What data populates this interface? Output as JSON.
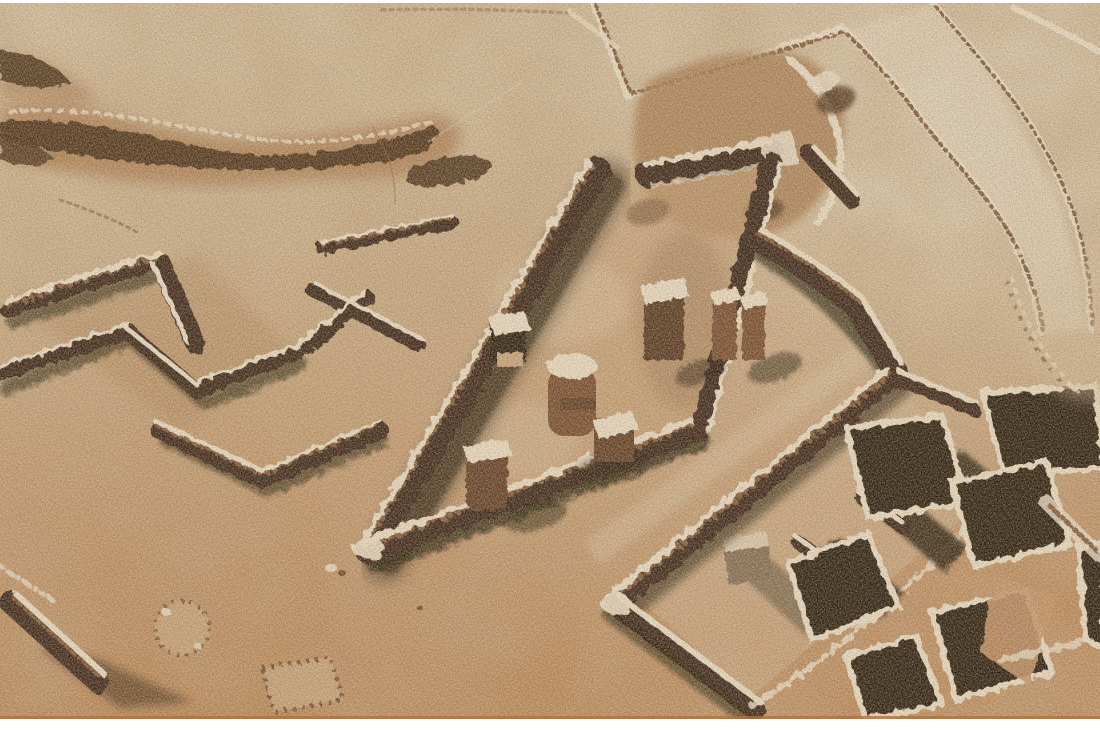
{
  "image": {
    "kind": "aerial photograph",
    "alt": "Oblique aerial photograph of an archaeological excavation in desert sand: dark dry-stone wall foundations outline a central rectangular court containing standing column bases and an altar block; a long hall with partition walls and a room complex filled with deep black shadows lies to the lower right; an eroded dark gully crosses the pale sand at upper left; thin rubble field-wall lines cross the upper right; faint stone rings and a detached wall with a long cast shadow sit in open orange-tan sand at lower left. The photo has a thin white border at top and a wider white strip at the bottom.",
    "border_note": "white frame strip top and bottom, no text or watermark visible"
  },
  "palette": {
    "frame_white": "#ffffff",
    "sand_base": "#cdb38f",
    "sand_pale": "#ddcdb0",
    "sand_palest": "#e7dbc4",
    "sand_pink": "#c9a278",
    "sand_warm": "#c69465",
    "sand_orange": "#bd8452",
    "rubble_cream": "#f1e6d0",
    "wall_dark": "#2a160a",
    "wall_face": "#56321a",
    "wall_red": "#6e4226",
    "shadow_black": "#140a04",
    "trench_dark": "#3c2410",
    "trench_halo": "#a8744a",
    "mound_brown": "#a87c50",
    "speckle_brown": "#7a5230",
    "fringe_orange": "#b4713f"
  },
  "scene": {
    "features": [
      "eroded gully with rubble",
      "rubble field-wall lines and pale track",
      "stone rubble mound with pits",
      "cluster of excavated room walls",
      "central walled court",
      "altar block against west wall",
      "round column base with step blocks",
      "standing pillar",
      "pillar pair on east wall",
      "column stump with cast shadow",
      "long hall with partition stubs",
      "room complex in deep shadow",
      "detached wall with long cast shadow",
      "stone ring outline",
      "rectangular stone outline",
      "circular rubble arc at right edge"
    ]
  }
}
